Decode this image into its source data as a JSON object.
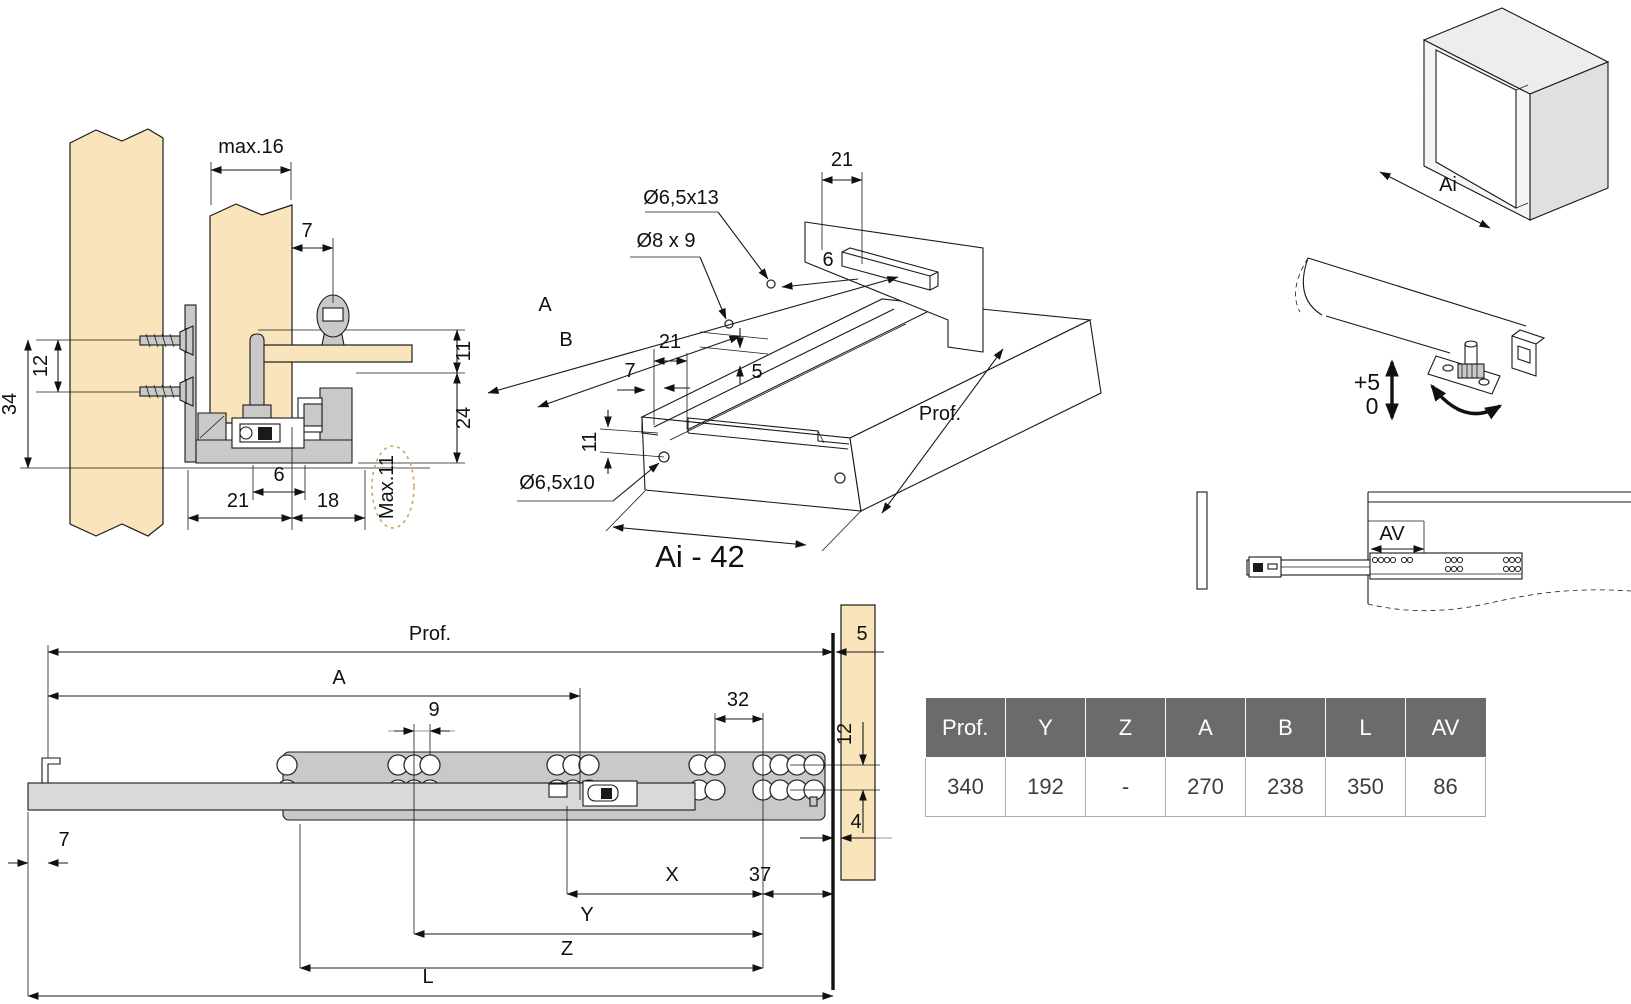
{
  "views": {
    "cross_section": {
      "dims": {
        "max16": "max.16",
        "top7": "7",
        "v12": "12",
        "v34": "34",
        "r11": "11",
        "r24": "24",
        "b6": "6",
        "b21": "21",
        "b18": "18",
        "max11": "Max.11"
      }
    },
    "iso": {
      "dims": {
        "top21": "21",
        "hole1": "Ø6,5x13",
        "hole2": "Ø8 x 9",
        "d6": "6",
        "A": "A",
        "B": "B",
        "f21": "21",
        "f7": "7",
        "f5": "5",
        "f11": "11",
        "hole3": "Ø6,5x10",
        "prof": "Prof.",
        "ai42": "Ai - 42"
      }
    },
    "cabinet": {
      "ai": "Ai"
    },
    "adjust": {
      "plus5": "+5",
      "zero": "0"
    },
    "side": {
      "av": "AV"
    },
    "bottom": {
      "dims": {
        "prof": "Prof.",
        "A": "A",
        "n9": "9",
        "n32": "32",
        "n5": "5",
        "n12": "12",
        "n4": "4",
        "n7": "7",
        "X": "X",
        "n37": "37",
        "Y": "Y",
        "Z": "Z",
        "L": "L"
      }
    }
  },
  "table": {
    "headers": [
      "Prof.",
      "Y",
      "Z",
      "A",
      "B",
      "L",
      "AV"
    ],
    "rows": [
      [
        "340",
        "192",
        "-",
        "270",
        "238",
        "350",
        "86"
      ]
    ]
  },
  "colors": {
    "wood": "#f9e4bc",
    "metal": "#c9c9c9",
    "line": "#1a1a1a",
    "table_header_bg": "#6a6b6d",
    "max11_dash": "#c9a35c"
  }
}
